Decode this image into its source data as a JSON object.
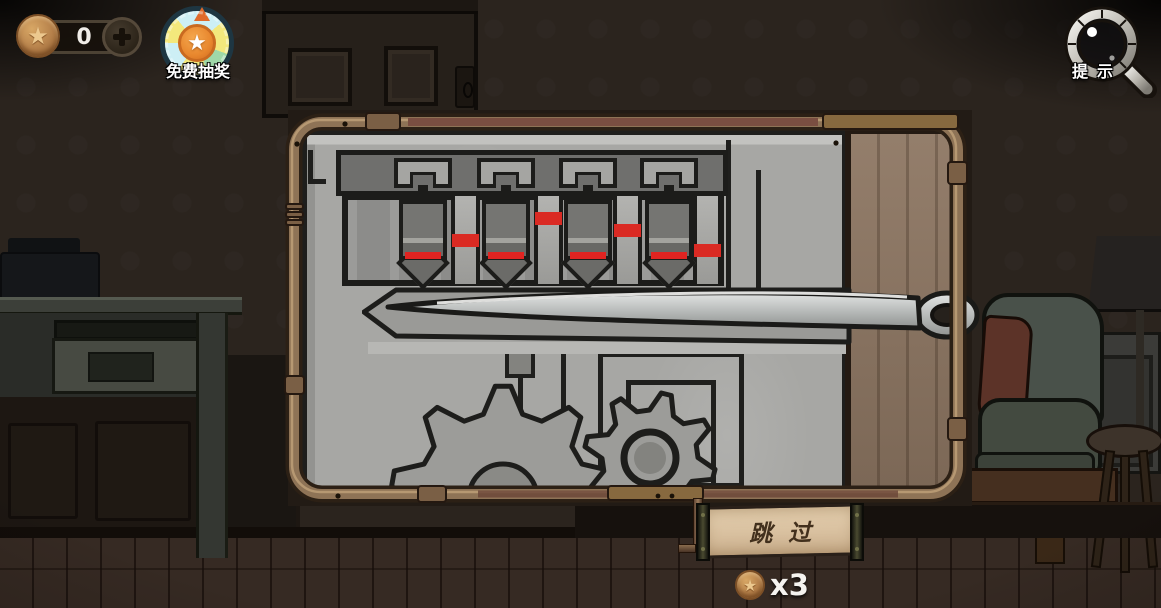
{
  "hud": {
    "star_counter": {
      "value": "0",
      "coin_icon": "star-coin-icon",
      "add_icon": "plus-icon"
    },
    "free_draw_badge": {
      "label": "免费抽奖",
      "icon": "prize-wheel-icon",
      "star": "★"
    },
    "hint_button": {
      "label": "提示",
      "icon": "magnifier-icon"
    }
  },
  "puzzle_panel": {
    "description": "needle-and-pin lock mechanism with gears",
    "pin_width": 48,
    "red_line_color": "#e02421",
    "marker_color": "#da2a23",
    "pins": [
      {
        "id": 1,
        "x": 399,
        "marker_x": 452,
        "marker_y": 234
      },
      {
        "id": 2,
        "x": 482,
        "marker_x": 535,
        "marker_y": 212
      },
      {
        "id": 3,
        "x": 564,
        "marker_x": 614,
        "marker_y": 224
      },
      {
        "id": 4,
        "x": 645,
        "marker_x": 694,
        "marker_y": 244
      }
    ],
    "gears": [
      {
        "cx": 503,
        "cy": 498,
        "teeth": 9,
        "r_body": 86,
        "r_tooth": 112,
        "hole_r": 34
      },
      {
        "cx": 650,
        "cy": 458,
        "teeth": 8,
        "r_body": 48,
        "r_tooth": 66,
        "hole_r": 26
      }
    ]
  },
  "skip_button": {
    "label": "跳过",
    "cost": "x3",
    "coin_icon": "star-coin-icon",
    "star": "★"
  },
  "colors": {
    "marker_red": "#da2a23",
    "pipe_copper": "#8e7356",
    "plate_gray": "#a7a7a4",
    "panel_wood": "#8d7662",
    "parchment": "#dcc6a6"
  }
}
